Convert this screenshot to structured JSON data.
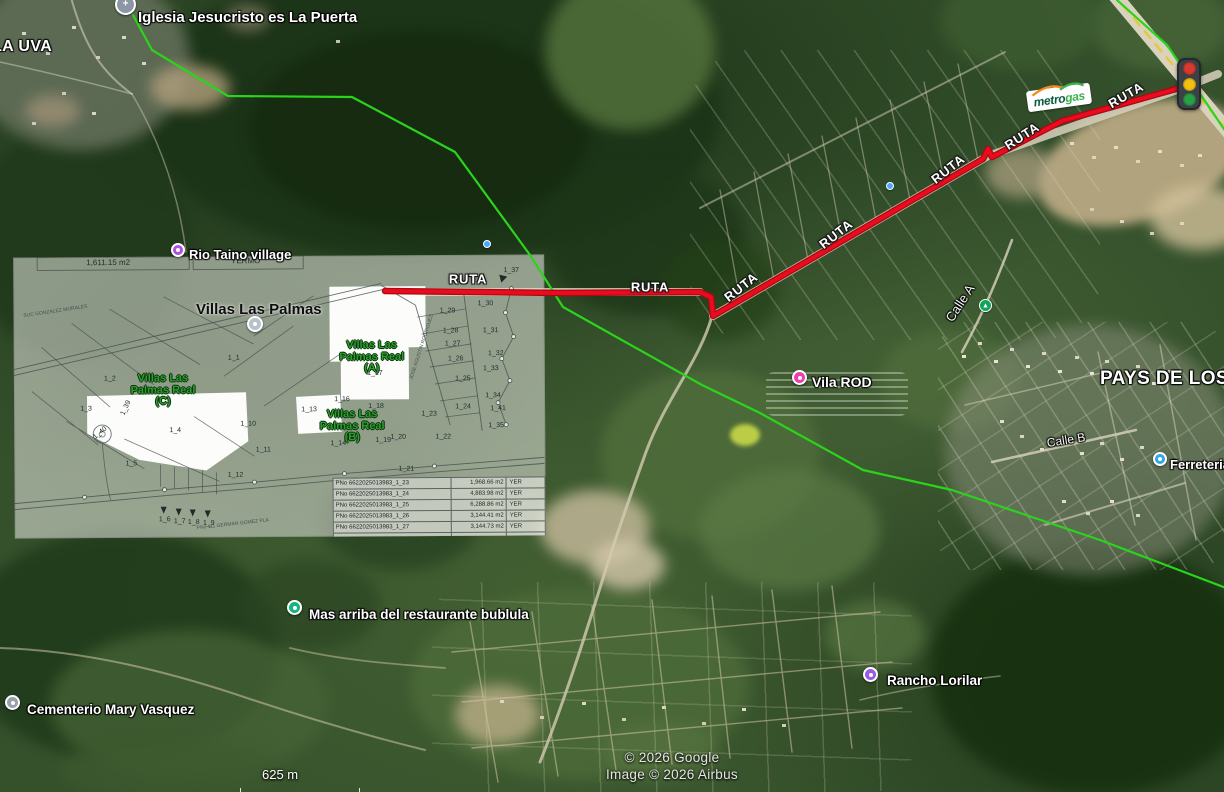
{
  "attribution": {
    "google": "© 2026 Google",
    "airbus": "Image © 2026 Airbus"
  },
  "scale_bar": {
    "label": "625 m"
  },
  "route": {
    "name": "RUTA",
    "color": "#ea0c1e",
    "casing_color": "#ad0812",
    "points": [
      [
        385,
        291
      ],
      [
        560,
        293
      ],
      [
        700,
        292
      ],
      [
        711,
        297
      ],
      [
        713,
        316
      ],
      [
        983,
        159
      ],
      [
        988,
        149
      ],
      [
        992,
        157
      ],
      [
        1062,
        121
      ],
      [
        1183,
        87
      ]
    ],
    "labels": [
      {
        "x": 468,
        "y": 279,
        "rot": 0
      },
      {
        "x": 650,
        "y": 287,
        "rot": 0
      },
      {
        "x": 741,
        "y": 287,
        "rot": -38
      },
      {
        "x": 836,
        "y": 234,
        "rot": -38
      },
      {
        "x": 948,
        "y": 169,
        "rot": -38
      },
      {
        "x": 1022,
        "y": 136,
        "rot": -33
      },
      {
        "x": 1126,
        "y": 95,
        "rot": -30
      }
    ]
  },
  "boundary": {
    "color": "#2bd41c",
    "segments": [
      [
        [
          133,
          15
        ],
        [
          152,
          50
        ],
        [
          228,
          96
        ],
        [
          352,
          97
        ],
        [
          455,
          152
        ],
        [
          530,
          255
        ],
        [
          563,
          307
        ],
        [
          702,
          385
        ],
        [
          760,
          413
        ],
        [
          863,
          470
        ],
        [
          952,
          490
        ],
        [
          1100,
          540
        ],
        [
          1226,
          588
        ]
      ],
      [
        [
          1117,
          0
        ],
        [
          1167,
          45
        ],
        [
          1226,
          132
        ]
      ]
    ]
  },
  "places": [
    {
      "name": "LA UVA",
      "kind": "town",
      "x": -8,
      "y": 38,
      "size": 16
    },
    {
      "name": "Iglesia Jesucristo es La Puerta",
      "kind": "poi",
      "icon": "church-icon",
      "glyph": "+",
      "color": "#8b97a5",
      "px": 115,
      "py": -6,
      "pw": 21,
      "x": 138,
      "y": 9,
      "size": 15
    },
    {
      "name": "Rio Taino village",
      "kind": "poi",
      "icon": "village-icon",
      "color": "#b04fe0",
      "px": 171,
      "py": 243,
      "pw": 14,
      "x": 189,
      "y": 247,
      "size": 13
    },
    {
      "name": "Villas Las Palmas",
      "kind": "dark",
      "icon": "neighborhood-icon",
      "color": "#b7c2cb",
      "px": 247,
      "py": 316,
      "pw": 16,
      "x": 196,
      "y": 301,
      "size": 15
    },
    {
      "name": "Vila ROD",
      "kind": "poi",
      "icon": "lodging-icon",
      "color": "#ec3fae",
      "px": 792,
      "py": 370,
      "pw": 15,
      "x": 812,
      "y": 374,
      "size": 14
    },
    {
      "name": "PAYS DE LOS CID",
      "kind": "town",
      "x": 1100,
      "y": 368,
      "size": 19
    },
    {
      "name": "Calle A",
      "kind": "street",
      "x": 960,
      "y": 303,
      "rot": -57,
      "size": 13
    },
    {
      "name": "Calle B",
      "kind": "street",
      "x": 1066,
      "y": 440,
      "rot": -9,
      "size": 12
    },
    {
      "name": "Ferreteria",
      "kind": "poi",
      "icon": "hardware-store-icon",
      "color": "#31a6e8",
      "px": 1153,
      "py": 452,
      "pw": 14,
      "x": 1170,
      "y": 457,
      "size": 13
    },
    {
      "name": "Mas arriba del restaurante bublula",
      "kind": "poi",
      "icon": "restaurant-icon",
      "color": "#18b37e",
      "px": 287,
      "py": 600,
      "pw": 15,
      "x": 309,
      "y": 607,
      "size": 13.5
    },
    {
      "name": "Cementerio Mary Vasquez",
      "kind": "poi",
      "icon": "cemetery-icon",
      "color": "#97a2ac",
      "px": 5,
      "py": 695,
      "pw": 15,
      "x": 27,
      "y": 702,
      "size": 13.5
    },
    {
      "name": "Rancho Lorilar",
      "kind": "poi",
      "icon": "ranch-icon",
      "color": "#9b59e8",
      "px": 863,
      "py": 667,
      "pw": 15,
      "x": 887,
      "y": 673,
      "size": 13.5
    }
  ],
  "poi_dots": [
    {
      "x": 886,
      "y": 182,
      "color": "#4aa8ff",
      "icon": "poi-dot-icon",
      "size": 8
    },
    {
      "x": 483,
      "y": 240,
      "color": "#4aa8ff",
      "icon": "poi-dot-icon",
      "size": 8
    },
    {
      "x": 979,
      "y": 299,
      "color": "#12a35c",
      "glyph": "▲",
      "icon": "transit-stop-icon",
      "size": 13
    }
  ],
  "traffic_light": {
    "lights": [
      "#d93a30",
      "#f2c011",
      "#27a144"
    ]
  },
  "metrogas": {
    "text_dark": "metro",
    "text_green": "gas",
    "dark_color": "#0a5b3c",
    "green_color": "#3cb24a",
    "accent_color": "#f28a1c"
  },
  "overlay": {
    "header_cells": [
      "1,611.15 m2",
      "YERMO"
    ],
    "green_labels": [
      {
        "lines": [
          "Villas Las",
          "Palmas Real",
          "(A)"
        ],
        "x": 358,
        "y": 102
      },
      {
        "lines": [
          "Villas Las",
          "Palmas Real",
          "(B)"
        ],
        "x": 338,
        "y": 171
      },
      {
        "lines": [
          "Villas Las",
          "Palmas Real",
          "(C)"
        ],
        "x": 149,
        "y": 134
      }
    ],
    "lots": [
      {
        "id": "1_1",
        "x": 220,
        "y": 102
      },
      {
        "id": "1_2",
        "x": 96,
        "y": 122
      },
      {
        "id": "1_3",
        "x": 72,
        "y": 152
      },
      {
        "id": "1_4",
        "x": 161,
        "y": 174
      },
      {
        "id": "1_5",
        "x": 117,
        "y": 207
      },
      {
        "id": "1_6",
        "x": 150,
        "y": 263
      },
      {
        "id": "1_7",
        "x": 165,
        "y": 265
      },
      {
        "id": "1_8",
        "x": 179,
        "y": 266
      },
      {
        "id": "1_9",
        "x": 194,
        "y": 267
      },
      {
        "id": "1_10",
        "x": 234,
        "y": 168
      },
      {
        "id": "1_11",
        "x": 249,
        "y": 194
      },
      {
        "id": "1_12",
        "x": 221,
        "y": 219
      },
      {
        "id": "1_13",
        "x": 295,
        "y": 154
      },
      {
        "id": "1_14",
        "x": 324,
        "y": 188
      },
      {
        "id": "1_16",
        "x": 328,
        "y": 144
      },
      {
        "id": "1_17",
        "x": 361,
        "y": 118
      },
      {
        "id": "1_18",
        "x": 362,
        "y": 151
      },
      {
        "id": "1_19",
        "x": 369,
        "y": 185
      },
      {
        "id": "1_20",
        "x": 384,
        "y": 182
      },
      {
        "id": "1_21",
        "x": 392,
        "y": 214
      },
      {
        "id": "1_22",
        "x": 429,
        "y": 182
      },
      {
        "id": "1_23",
        "x": 415,
        "y": 159
      },
      {
        "id": "1_24",
        "x": 449,
        "y": 152
      },
      {
        "id": "1_25",
        "x": 449,
        "y": 124
      },
      {
        "id": "1_26",
        "x": 442,
        "y": 104
      },
      {
        "id": "1_27",
        "x": 439,
        "y": 89
      },
      {
        "id": "1_28",
        "x": 437,
        "y": 76
      },
      {
        "id": "1_29",
        "x": 434,
        "y": 56
      },
      {
        "id": "1_30",
        "x": 472,
        "y": 49
      },
      {
        "id": "1_31",
        "x": 477,
        "y": 76
      },
      {
        "id": "1_32",
        "x": 482,
        "y": 99
      },
      {
        "id": "1_33",
        "x": 477,
        "y": 114
      },
      {
        "id": "1_34",
        "x": 479,
        "y": 141
      },
      {
        "id": "1_35",
        "x": 482,
        "y": 171
      },
      {
        "id": "1_37",
        "x": 498,
        "y": 16
      },
      {
        "id": "1_39",
        "x": 112,
        "y": 151,
        "rot": -65
      },
      {
        "id": "1_40",
        "x": 86,
        "y": 176,
        "rot": -40
      },
      {
        "id": "1_41",
        "x": 484,
        "y": 154
      }
    ],
    "micro_texts": [
      {
        "text": "JOSE AGUSTIN RODRIGUEZ",
        "x": 408,
        "y": 92,
        "rot": -72
      },
      {
        "text": "PNo 111  GERMAN GOMEZ PLA",
        "x": 218,
        "y": 268,
        "rot": -6
      },
      {
        "text": "SUC GONZALEZ MORALES",
        "x": 42,
        "y": 54,
        "rot": -8
      }
    ],
    "table": {
      "rows": [
        [
          "PNo 6622025013983_1_23",
          "1,968.66 m2",
          "YER"
        ],
        [
          "PNo 6622025013983_1_24",
          "4,883.98 m2",
          "YER"
        ],
        [
          "PNo 6622025013983_1_25",
          "6,288.86 m2",
          "YER"
        ],
        [
          "PNo 6622025013983_1_26",
          "3,144.41 m2",
          "YER"
        ],
        [
          "PNo 6622025013983_1_27",
          "3,144.73 m2",
          "YER"
        ]
      ]
    }
  }
}
